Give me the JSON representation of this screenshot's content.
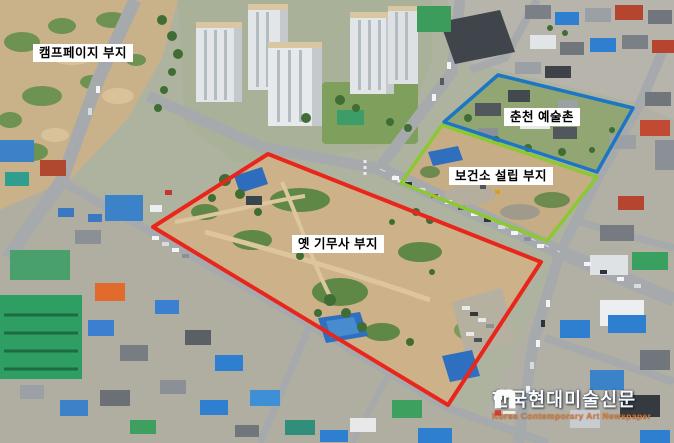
{
  "page": {
    "type": "annotated aerial photograph",
    "width": 674,
    "height": 443
  },
  "annotations": {
    "camp_page": {
      "label": "캠프페이지 부지"
    },
    "art_village": {
      "label": "춘천 예술촌",
      "outline_color": "#1d76c4",
      "points": "444,122 498,75 633,108 597,172"
    },
    "health_center": {
      "label": "보건소 설립 부지",
      "outline_color": "#8cc832",
      "points": "442,125 597,177 547,241 401,183"
    },
    "gimusa": {
      "label": "옛 기무사 부지",
      "outline_color": "#e8261c",
      "points": "268,154 541,262 448,405 153,227"
    }
  },
  "watermark": {
    "korean": "한국현대미술신문",
    "english": "Korea Contemporary Art Newspaper",
    "english_color": "#e77f35",
    "label_background": "#ffffff",
    "label_text_color": "#000000"
  }
}
